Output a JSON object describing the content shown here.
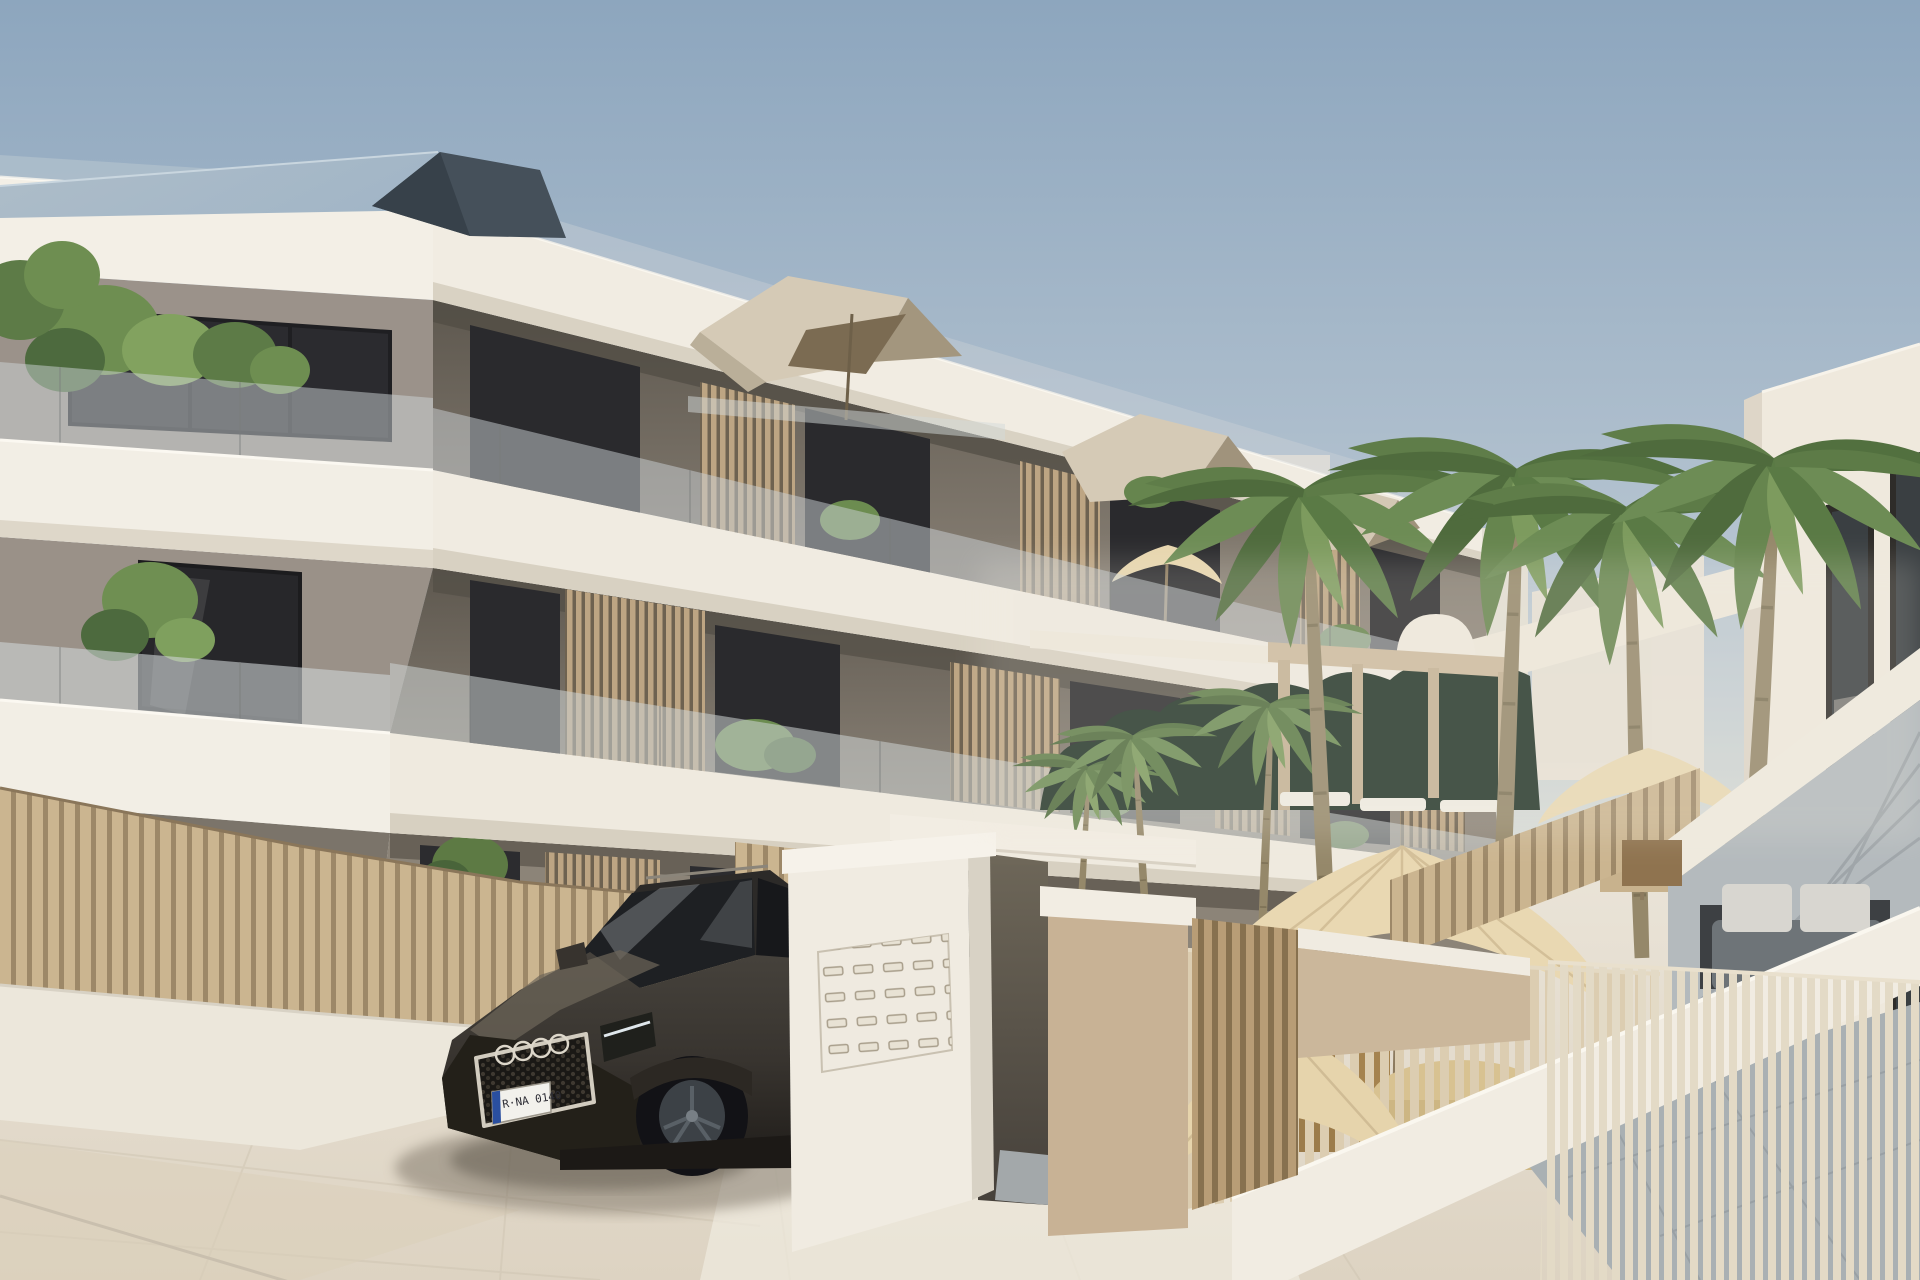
{
  "scene": {
    "description": "Architectural render of a modern three-storey apartment building with white balcony bands, wood slat screens and glass balustrades; dark SUV parked at an entrance gate with mailbox pillar; palm-tree courtyard with cream umbrellas, hedge, pergola and staircase beside a white building on the right.",
    "building": {
      "floors": 3,
      "balcony_screens": "vertical wood slats",
      "balustrades": "frosted glass"
    },
    "car": {
      "type": "SUV",
      "color": "dark grey",
      "emblem": "four overlapping rings",
      "license_plate": "R·NA 0140"
    },
    "counts": {
      "palm_trees_large": 4,
      "palm_trees_small": 3,
      "umbrellas": 4,
      "mailbox_rows": 5,
      "mailbox_cols": 5
    }
  },
  "palette": {
    "sky_top": "#8da6be",
    "sky_mid": "#d9dcd7",
    "sky_horizon": "#efebe0",
    "band_white": "#f1ece2",
    "wall_taupe": "#9a9188",
    "window_dark": "#2a2a2d",
    "wood_screen": "#b29a77",
    "fence_slat": "#cbb590",
    "glass_tint": "#cdd3d4",
    "plant_green": "#66854e",
    "hedge_dark": "#223428",
    "roof_slate": "#45505a",
    "roof_sheen": "#9fb4c6",
    "penthouse_beige": "#d5cab6",
    "parasol_tan": "#7b6b52",
    "umbrella_cream": "#e9d8b2",
    "gate_white": "#f0ebe1",
    "gate_tan": "#c8b295",
    "paving": "#e9e3d7",
    "tile_gray": "#a9b0b3",
    "car_body": "#38342f",
    "chrome": "#d2ccbf",
    "plate_blue": "#2a4fa0"
  }
}
